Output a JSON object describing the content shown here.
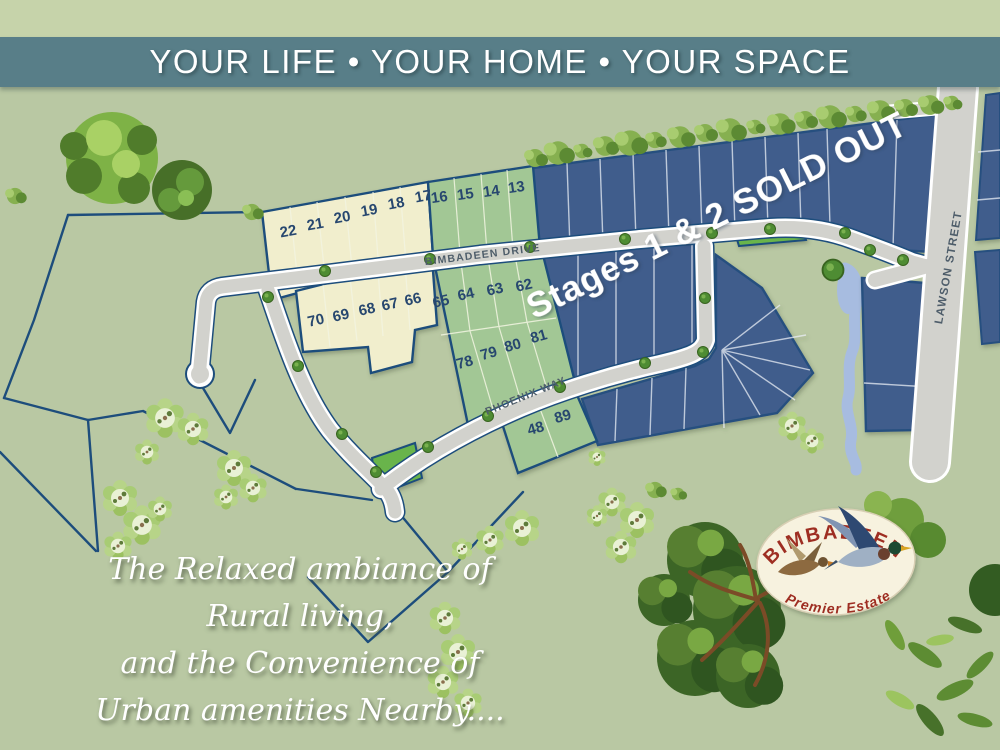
{
  "banner": {
    "title": "YOUR LIFE • YOUR HOME • YOUR SPACE"
  },
  "map": {
    "streets": {
      "bimbadeen": "BIMBADEEN DRIVE",
      "phoenix": "PHOENIX WAY",
      "lawson": "LAWSON STREET"
    },
    "sold_out": "Stages 1 & 2 SOLD OUT",
    "lots": {
      "row1_cream": [
        "22",
        "21",
        "20",
        "19",
        "18",
        "17"
      ],
      "row1_green": [
        "16",
        "15",
        "14",
        "13"
      ],
      "row2_cream": [
        "70",
        "69",
        "68",
        "67",
        "66"
      ],
      "row2_green": [
        "65",
        "64",
        "63",
        "62"
      ],
      "row3_green": [
        "78",
        "79",
        "80",
        "81"
      ],
      "row4_green": [
        "48",
        "89"
      ]
    },
    "colors": {
      "sold_lot": "#3f5d8c",
      "available_green_lot": "#a2c795",
      "available_cream_lot": "#f1eecd",
      "reserve_green": "#69b44b",
      "road": "#d2d2cd",
      "water": "#a7bce0",
      "boundary": "#1d4d7c",
      "background": "#b9c8a3",
      "banner": "#587e88"
    }
  },
  "logo": {
    "name": "BIMBADEEN",
    "tagline": "Premier Estate"
  },
  "tagline": {
    "lines": [
      "The Relaxed ambiance of",
      "Rural living,",
      "and the Convenience of",
      "Urban amenities Nearby...."
    ]
  }
}
